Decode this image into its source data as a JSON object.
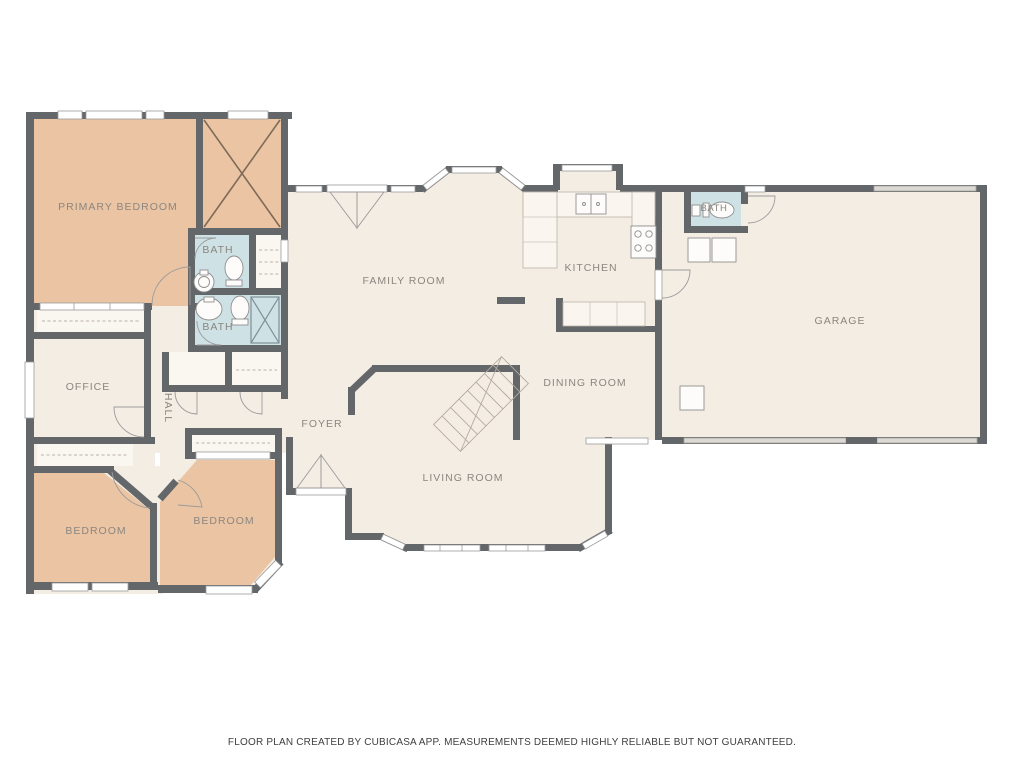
{
  "title": "Residential floor plan",
  "rooms": {
    "primary_bedroom": "PRIMARY BEDROOM",
    "bath_primary": "BATH",
    "bath_hall": "BATH",
    "office": "OFFICE",
    "hall": "HALL",
    "bedroom_left": "BEDROOM",
    "bedroom_right": "BEDROOM",
    "foyer": "FOYER",
    "family_room": "FAMILY ROOM",
    "kitchen": "KITCHEN",
    "dining_room": "DINING ROOM",
    "living_room": "LIVING ROOM",
    "garage": "GARAGE",
    "bath_garage": "BATH"
  },
  "footer": {
    "disclaimer": "FLOOR PLAN CREATED BY CUBICASA APP. MEASUREMENTS DEEMED HIGHLY RELIABLE BUT NOT GUARANTEED."
  },
  "colors": {
    "wall": "#63676A",
    "floor": "#F4EDE4",
    "bedroom_fill": "#EBC4A3",
    "bath_fill": "#CEE1E4",
    "closet_fill": "#FAF6F0",
    "label_text": "#8C8680",
    "background": "#FFFFFF"
  }
}
